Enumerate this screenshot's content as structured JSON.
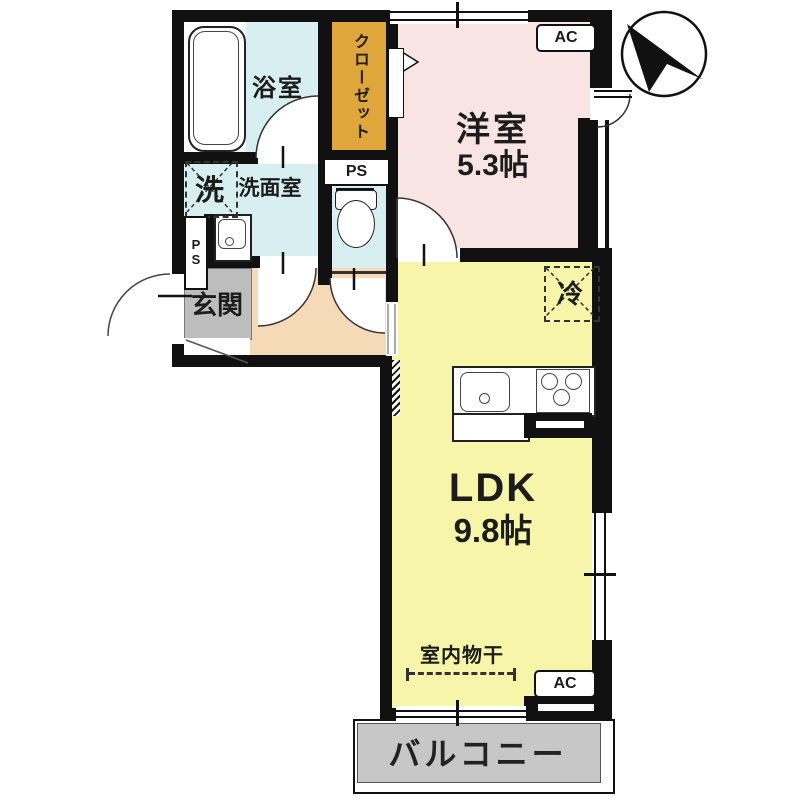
{
  "rooms": {
    "bathroom": {
      "label": "浴室"
    },
    "closet": {
      "label": "クローゼット"
    },
    "washroom": {
      "label": "洗面室"
    },
    "western": {
      "label": "洋室",
      "size": "5.3帖"
    },
    "entrance": {
      "label": "玄関"
    },
    "ldk": {
      "label": "LDK",
      "size": "9.8帖"
    },
    "balcony": {
      "label": "バルコニー"
    }
  },
  "fixtures": {
    "washer": {
      "label": "洗"
    },
    "fridge": {
      "label": "冷"
    },
    "indoor_drying": {
      "label": "室内物干"
    }
  },
  "badges": {
    "ac_bedroom": "AC",
    "ac_ldk": "AC",
    "ps_toilet": "PS",
    "ps_washroom_p": "P",
    "ps_washroom_s": "S"
  },
  "colors": {
    "wall": "#111111",
    "water_rooms": "#d7eff1",
    "closet": "#dfa63c",
    "bedroom": "#f8e4e2",
    "ldk": "#f6f5a9",
    "hallway": "#f6d9b6",
    "entrance_mat": "#bdbdbd",
    "balcony": "#c7c7c7"
  }
}
